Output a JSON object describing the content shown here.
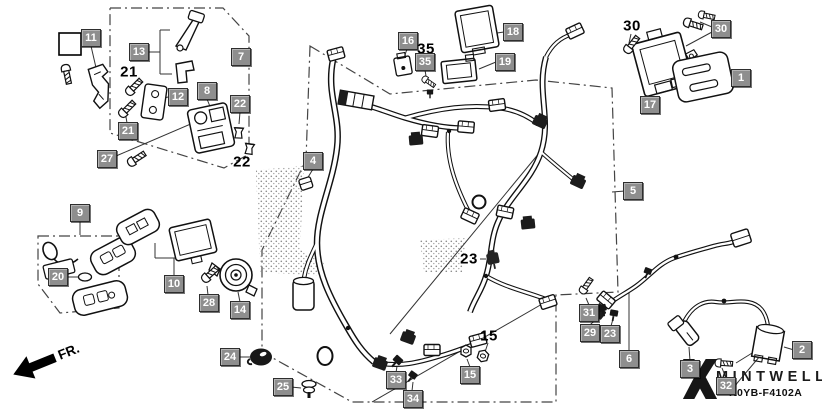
{
  "diagram": {
    "type": "wire-harness-parts-diagram",
    "code": "K0YB-F4102A",
    "watermark_brand": "MINTWELL",
    "front_marker": "FR.",
    "colors": {
      "background": "#ffffff",
      "line_art": "#1a1a1a",
      "label_box_bg": "#8e8e8e",
      "label_box_border": "#2e2e2e",
      "label_box_text": "#ffffff",
      "plain_label_text": "#000000"
    },
    "callout_labels": [
      {
        "n": "11",
        "x": 91,
        "y": 38,
        "style": "box"
      },
      {
        "n": "13",
        "x": 139,
        "y": 52,
        "style": "box"
      },
      {
        "n": "7",
        "x": 241,
        "y": 57,
        "style": "box"
      },
      {
        "n": "21",
        "x": 129,
        "y": 72,
        "style": "text"
      },
      {
        "n": "12",
        "x": 178,
        "y": 97,
        "style": "box"
      },
      {
        "n": "8",
        "x": 207,
        "y": 91,
        "style": "box"
      },
      {
        "n": "22",
        "x": 240,
        "y": 104,
        "style": "box"
      },
      {
        "n": "21",
        "x": 128,
        "y": 131,
        "style": "box"
      },
      {
        "n": "27",
        "x": 107,
        "y": 159,
        "style": "box"
      },
      {
        "n": "22",
        "x": 242,
        "y": 162,
        "style": "text"
      },
      {
        "n": "9",
        "x": 80,
        "y": 213,
        "style": "box"
      },
      {
        "n": "20",
        "x": 58,
        "y": 277,
        "style": "box"
      },
      {
        "n": "10",
        "x": 174,
        "y": 284,
        "style": "box"
      },
      {
        "n": "28",
        "x": 209,
        "y": 303,
        "style": "box"
      },
      {
        "n": "14",
        "x": 240,
        "y": 310,
        "style": "box"
      },
      {
        "n": "4",
        "x": 313,
        "y": 161,
        "style": "box"
      },
      {
        "n": "16",
        "x": 408,
        "y": 41,
        "style": "box"
      },
      {
        "n": "35",
        "x": 426,
        "y": 49,
        "style": "text"
      },
      {
        "n": "35",
        "x": 425,
        "y": 62,
        "style": "box"
      },
      {
        "n": "18",
        "x": 513,
        "y": 32,
        "style": "box"
      },
      {
        "n": "19",
        "x": 505,
        "y": 62,
        "style": "box"
      },
      {
        "n": "30",
        "x": 632,
        "y": 26,
        "style": "text"
      },
      {
        "n": "30",
        "x": 721,
        "y": 29,
        "style": "box"
      },
      {
        "n": "17",
        "x": 650,
        "y": 105,
        "style": "box"
      },
      {
        "n": "1",
        "x": 741,
        "y": 78,
        "style": "box"
      },
      {
        "n": "5",
        "x": 633,
        "y": 191,
        "style": "box"
      },
      {
        "n": "23",
        "x": 469,
        "y": 259,
        "style": "text"
      },
      {
        "n": "24",
        "x": 230,
        "y": 357,
        "style": "box"
      },
      {
        "n": "25",
        "x": 283,
        "y": 387,
        "style": "box"
      },
      {
        "n": "15",
        "x": 489,
        "y": 336,
        "style": "text"
      },
      {
        "n": "33",
        "x": 396,
        "y": 380,
        "style": "box"
      },
      {
        "n": "34",
        "x": 413,
        "y": 399,
        "style": "box"
      },
      {
        "n": "15",
        "x": 470,
        "y": 375,
        "style": "box"
      },
      {
        "n": "31",
        "x": 589,
        "y": 313,
        "style": "box"
      },
      {
        "n": "29",
        "x": 590,
        "y": 333,
        "style": "box"
      },
      {
        "n": "23",
        "x": 610,
        "y": 334,
        "style": "box"
      },
      {
        "n": "6",
        "x": 629,
        "y": 359,
        "style": "box"
      },
      {
        "n": "3",
        "x": 690,
        "y": 369,
        "style": "box"
      },
      {
        "n": "2",
        "x": 802,
        "y": 350,
        "style": "box"
      },
      {
        "n": "32",
        "x": 726,
        "y": 386,
        "style": "box"
      }
    ]
  }
}
